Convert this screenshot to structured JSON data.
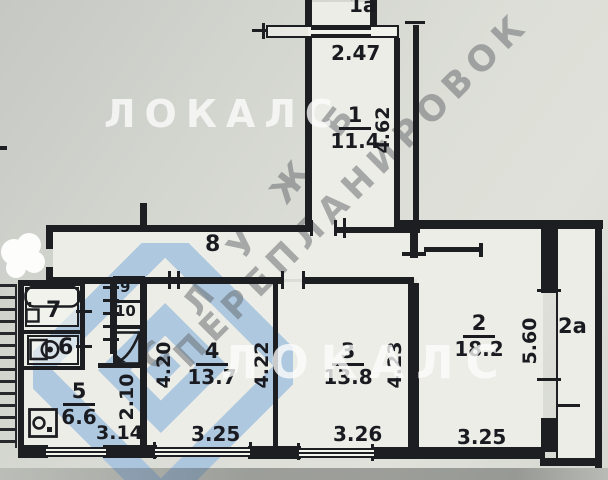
{
  "watermarks": {
    "brand_top": "ЛОКАЛС",
    "brand_center": "ЛОКАЛС",
    "diagonal_word1": "С Л У Ж Б",
    "diagonal_word2": "ПЕРЕПЛАНИРОВОК"
  },
  "rooms": {
    "balcony_1a": {
      "label": "1а"
    },
    "room_1": {
      "label": "1",
      "area": "11.4"
    },
    "room_2": {
      "label": "2",
      "area": "18.2"
    },
    "balcony_2a": {
      "label": "2а"
    },
    "room_3": {
      "label": "3",
      "area": "13.8"
    },
    "room_4": {
      "label": "4",
      "area": "13.7"
    },
    "room_5": {
      "label": "5",
      "area": "6.6"
    },
    "room_6": {
      "label": "6"
    },
    "room_7": {
      "label": "7"
    },
    "room_8": {
      "label": "8"
    },
    "room_9": {
      "label": "9"
    },
    "room_10": {
      "label": "10"
    }
  },
  "dimensions": {
    "balcony_1a_width": "2.47",
    "room_1_depth": "4.62",
    "room_4_left_depth": "4.20",
    "room_4_right_depth": "4.22",
    "room_4_width": "3.25",
    "room_3_depth": "4.23",
    "room_3_width": "3.26",
    "room_2_depth": "5.60",
    "room_2_width": "3.25",
    "room_5_width": "3.14",
    "room_5_depth": "2.10"
  },
  "colors": {
    "wall": "#1d1e22",
    "paper": "#ecede6",
    "background": "#d5d7d1",
    "logo_blue": "#a4c2e0"
  }
}
